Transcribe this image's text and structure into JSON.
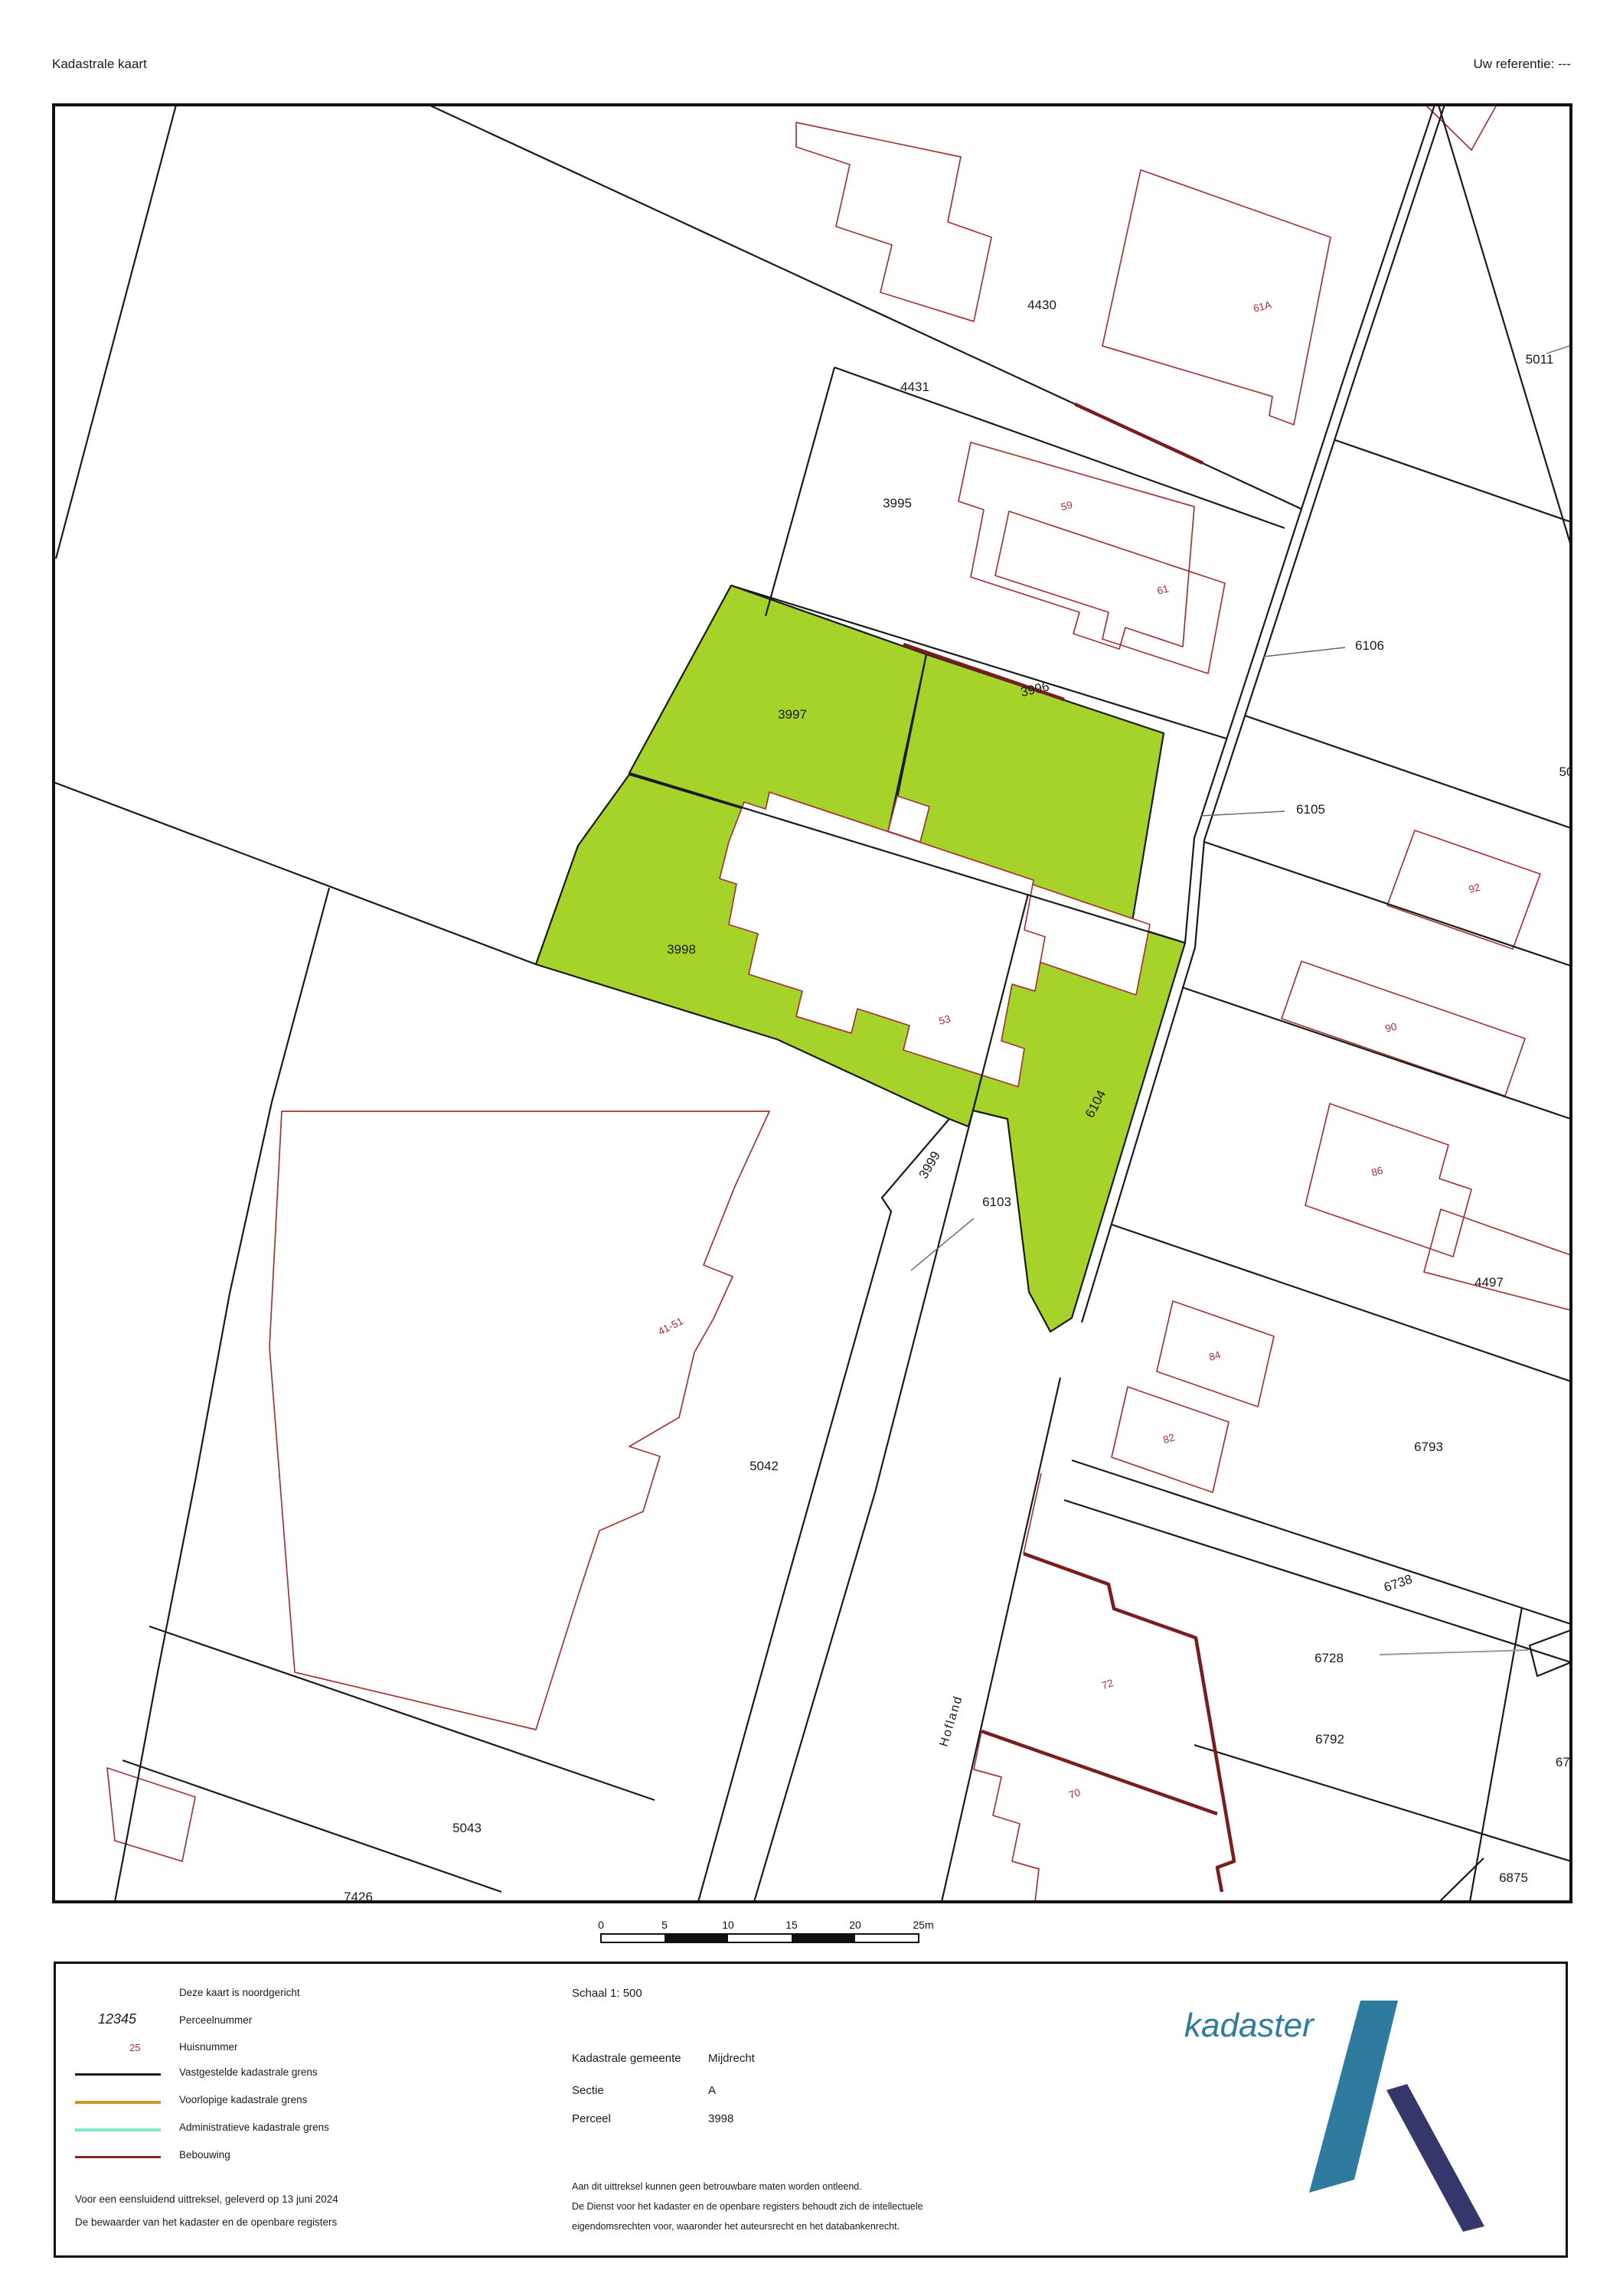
{
  "header": {
    "title": "Kadastrale kaart",
    "reference": "Uw referentie: ---"
  },
  "map": {
    "parcel_labels": {
      "p4430": "4430",
      "p4431": "4431",
      "p5011": "5011",
      "p3995": "3995",
      "p6106": "6106",
      "p3997": "3997",
      "p3996": "3996",
      "p6105": "6105",
      "p50": "50",
      "p3998": "3998",
      "p6104": "6104",
      "p4497": "4497",
      "p3999": "3999",
      "p6103": "6103",
      "p5042": "5042",
      "p6793": "6793",
      "p6738": "6738",
      "p6728": "6728",
      "p6792": "6792",
      "p672": "672",
      "p6875": "6875",
      "p5043": "5043",
      "p7426": "7426"
    },
    "house_numbers": {
      "h61A": "61A",
      "h61": "61",
      "h59": "59",
      "h92": "92",
      "h90": "90",
      "h86": "86",
      "h84": "84",
      "h82": "82",
      "h53": "53",
      "h41_51": "41-51",
      "h72": "72",
      "h70": "70"
    },
    "street": "Hofland",
    "scale_bar": {
      "ticks": [
        "0",
        "5",
        "10",
        "15",
        "20",
        "25m"
      ]
    }
  },
  "legend": {
    "north_note": "Deze kaart is noordgericht",
    "parcel_sample": "12345",
    "parcel_sample_label": "Perceelnummer",
    "house_sample": "25",
    "house_sample_label": "Huisnummer",
    "line_items": [
      {
        "label": "Vastgestelde kadastrale grens",
        "color": "#1a1a1a"
      },
      {
        "label": "Voorlopige kadastrale grens",
        "color": "#c8992e"
      },
      {
        "label": "Administratieve kadastrale grens",
        "color": "#7de6cf"
      },
      {
        "label": "Bebouwing",
        "color": "#8b2424"
      }
    ],
    "footer_line1": "Voor een eensluidend uittreksel, geleverd op 13 juni 2024",
    "footer_line2": "De bewaarder van het kadaster en de openbare registers"
  },
  "details": {
    "schaal": "Schaal 1: 500",
    "gemeente_label": "Kadastrale gemeente",
    "gemeente": "Mijdrecht",
    "sectie_label": "Sectie",
    "sectie": "A",
    "perceel_label": "Perceel",
    "perceel": "3998",
    "disclaimer_line1": "Aan dit uittreksel kunnen geen betrouwbare maten worden ontleend.",
    "disclaimer_line2": "De Dienst voor het kadaster en de openbare registers behoudt zich de intellectuele",
    "disclaimer_line3": "eigendomsrechten voor, waaronder het auteursrecht en het databankenrecht."
  },
  "logo": {
    "text": "kadaster"
  },
  "colors": {
    "highlight_green": "#a6d32a",
    "building_red": "#a03636",
    "bebouwing_dark": "#7a1d1d",
    "logo_teal": "#2f7ba0",
    "logo_navy": "#35376b"
  }
}
